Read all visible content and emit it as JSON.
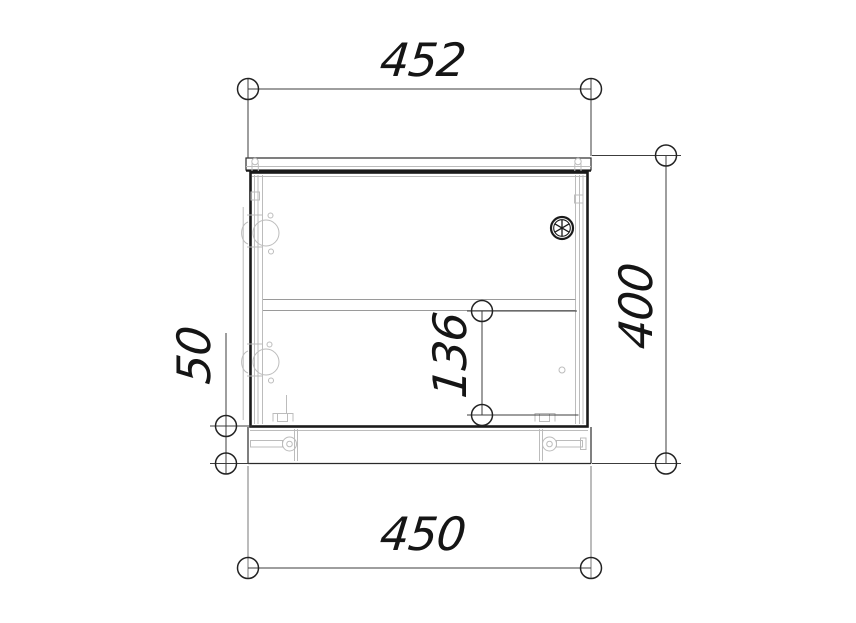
{
  "drawing": {
    "kind": "cabinet-front-view-technical-drawing",
    "dimensions": {
      "top_width": "452",
      "overall_height": "400",
      "shelf_to_bottom": "136",
      "base_height": "50",
      "bottom_width": "450"
    },
    "symbols": {
      "vent": "vent-fan-symbol",
      "terminator": "circle-dimension-terminator"
    },
    "colors": {
      "outline": "#1a1a1a",
      "detail": "#bcbcbc",
      "dimension": "#3c3c3c",
      "background": "#ffffff"
    }
  }
}
